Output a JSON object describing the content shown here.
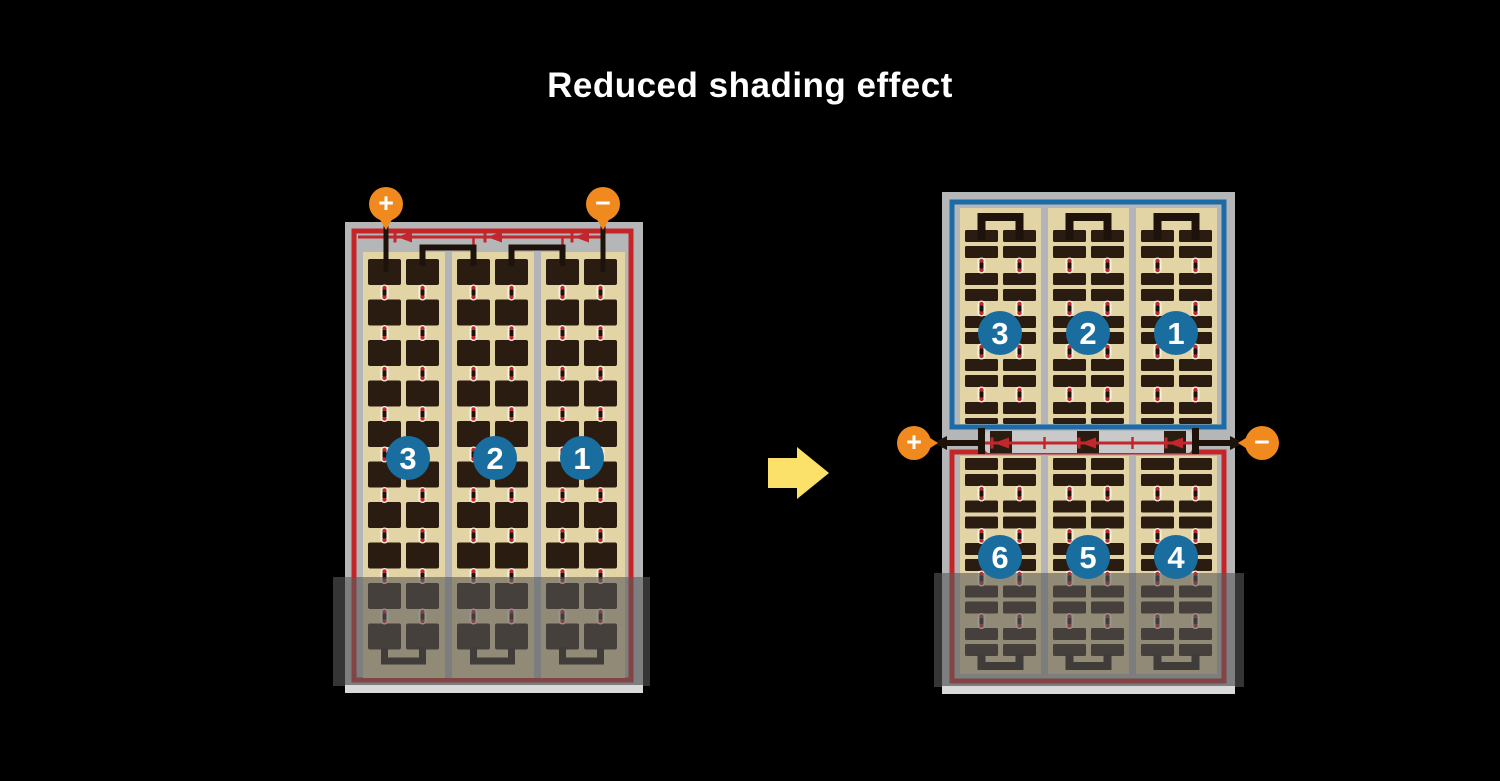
{
  "title": "Reduced shading effect",
  "colors": {
    "background": "#000000",
    "title_color": "#ffffff",
    "frame": "#b5b6b8",
    "frame_bevel": "#d9d9d9",
    "border_red": "#c42628",
    "border_blue": "#1c6aa6",
    "cell_area": "#e3d4a6",
    "cell": "#2a1c11",
    "separator": "#b2b4b9",
    "wire": "#1d130a",
    "bus_red": "#c1272d",
    "pad_gray": "#c9c9c9",
    "connector_white": "#f7f1de",
    "connector_dot": "#c1272d",
    "connector_core": "#1d130a",
    "terminal": "#f08a1f",
    "badge": "#196e9f",
    "badge_text": "#ffffff",
    "arrow": "#fbe06a",
    "shade": "rgba(88,88,88,0.6)"
  },
  "left_panel": {
    "terminal_plus": "+",
    "terminal_minus": "−",
    "badges": [
      {
        "label": "3"
      },
      {
        "label": "2"
      },
      {
        "label": "1"
      }
    ]
  },
  "right_panel": {
    "terminal_plus": "+",
    "terminal_minus": "−",
    "top_badges": [
      {
        "label": "3"
      },
      {
        "label": "2"
      },
      {
        "label": "1"
      }
    ],
    "bottom_badges": [
      {
        "label": "6"
      },
      {
        "label": "5"
      },
      {
        "label": "4"
      }
    ]
  }
}
